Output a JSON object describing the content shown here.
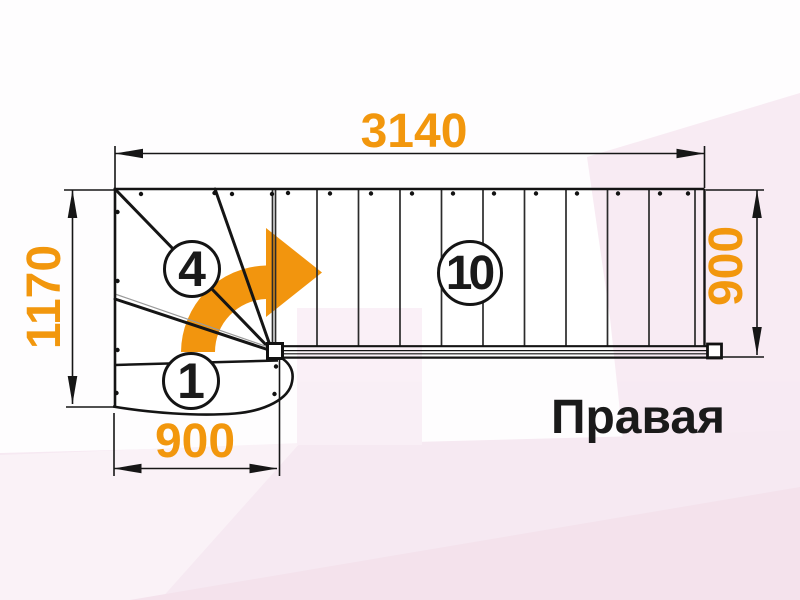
{
  "labels": {
    "orientation": "Правая"
  },
  "dims": {
    "top": "3140",
    "left": "1170",
    "right": "900",
    "bottom": "900"
  },
  "steps": {
    "winder": "4",
    "first": "1",
    "straight": "10"
  },
  "colors": {
    "accent_orange": "#F2970D",
    "line_black": "#1A1A1A",
    "background_pink": "#F7E9F2"
  },
  "icons": {
    "turn_direction_arrow": "curved-right-arrow"
  }
}
